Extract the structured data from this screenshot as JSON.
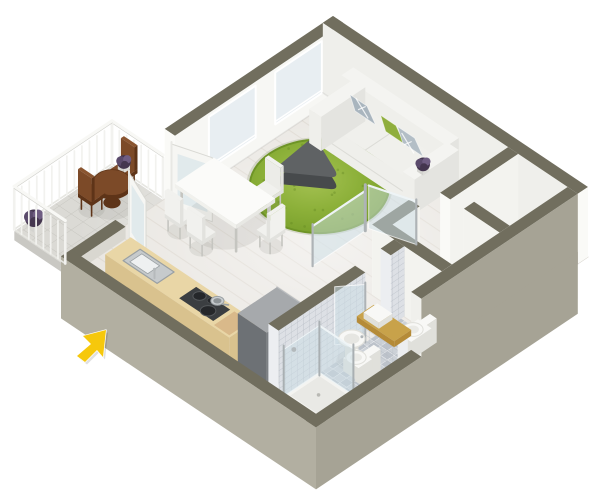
{
  "meta": {
    "description": "3D isometric dollhouse-style floor plan rendering of a studio apartment with living room, dining area, kitchen, bathroom and balcony, with a yellow cursor arrow at lower left",
    "width": 600,
    "height": 497
  },
  "colors": {
    "bg": "#ffffff",
    "floor": "#e9e6e1",
    "plank": "#ddd8d0",
    "wallTop": "#716e5e",
    "wallTopLight": "#7d7a69",
    "wallInnerNW": "#f7f7f4",
    "wallInnerNE": "#efefeb",
    "wallWhite": "#f3f3ef",
    "wallEnd": "#fafaf7",
    "skirtSE": "#a6a395",
    "skirtSW": "#b2afa1",
    "window": "#e8eef2",
    "windowFrame": "#ffffff",
    "glass": "rgba(204,222,230,0.5)",
    "glassEdge": "#eef4f6",
    "metal": "#aeb3b6",
    "rugEdge": "#6e9426",
    "rugDot": "#5f8520",
    "coffeeTop": "#5f6264",
    "coffeeSide": "#474a4c",
    "sofaTop": "#f4f4f1",
    "sofaFront": "#efefeb",
    "sofaSide": "#e4e4e0",
    "sofaSeat": "#f0f0ec",
    "seam": "#dcdcd7",
    "pillowGray": "#a9b5be",
    "pillowGray2": "#b3bec6",
    "pillowGreen": "#8fae3c",
    "tableTop": "#fbfbf9",
    "tableSide": "#e8e8e4",
    "leg": "#c5c5c0",
    "chairSeat": "#f1f1ee",
    "chairShade": "#e2e2de",
    "wood": "#7c4a28",
    "woodDark": "#5e3418",
    "woodTop": "#8a5530",
    "plantDark": "#44364f",
    "plantMid": "#5a4a6b",
    "plantHi": "#6f5d82",
    "pot": "#ececea",
    "counter": "#e9d6a6",
    "counterSide": "#d9c28e",
    "sinkSteel": "#c6cacc",
    "sinkDark": "#9aa0a3",
    "cooktop": "#3b3e41",
    "burner": "#25272a",
    "steel": "#c9cdd0",
    "board": "#d9b98a",
    "fridgeTop": "#a6a9ac",
    "fridgeX": "#7c8084",
    "fridgeY": "#6d7175",
    "tileBase": "#dde0e5",
    "tileLine": "#b4bac2",
    "bathFloor": "#ccd1d7",
    "gold": "#c8a24a",
    "goldSide": "#b58b38",
    "fixture": "#f8f8f6",
    "fixtureShade": "#e0e0db",
    "railing": "#f2f2ef",
    "railTop": "#f8f8f5",
    "railShadow": "#cfcfca",
    "balcTile": "#dbdad5",
    "balcEdge": "#c9c8c3",
    "shadow": "rgba(90,90,80,0.10)",
    "cursor": "#f6c80c"
  },
  "projection": {
    "origin": [
      333,
      86
    ],
    "ux": 0.85,
    "uy": 0.57,
    "wall_height": 70,
    "stub_height": 12,
    "skirt": 62
  },
  "plan": {
    "x_size": 300,
    "y_size": 320,
    "wall": 12
  },
  "nw_wall": {
    "full_to": 198,
    "stub_from": 256,
    "windows": [
      [
        25,
        80
      ],
      [
        103,
        158
      ]
    ],
    "win_z": [
      14,
      66
    ],
    "door": [
      198,
      256
    ]
  },
  "balcony": {
    "x": [
      -60,
      0
    ],
    "y": [
      200,
      315
    ],
    "rail_h": 42,
    "table": {
      "c": [
        -26,
        234
      ],
      "r": 16,
      "h": 22
    },
    "chair_a": {
      "x": [
        -44,
        -28
      ],
      "y": [
        202,
        218
      ],
      "back": "y0"
    },
    "chair_b": {
      "x": [
        -42,
        -26
      ],
      "y": [
        242,
        258
      ],
      "back": "y1"
    },
    "chair_plant": [
      -36,
      210
    ],
    "floor_plant": [
      -52,
      300
    ]
  },
  "balcony_door_leaves": [
    {
      "a": [
        12,
        202
      ],
      "b": [
        48,
        190
      ]
    },
    {
      "a": [
        12,
        252
      ],
      "b": [
        46,
        266
      ]
    }
  ],
  "living": {
    "sofa": {
      "arms": [
        [
          36,
          50
        ],
        [
          146,
          160
        ]
      ],
      "y": [
        12,
        64
      ],
      "back_y": [
        12,
        26
      ],
      "seat": [
        50,
        146
      ]
    },
    "rug": {
      "c": [
        80,
        96
      ],
      "r": 58
    },
    "coffee_table": {
      "pts": [
        [
          52,
          74
        ],
        [
          104,
          96
        ],
        [
          58,
          130
        ]
      ],
      "h": 22
    },
    "plant": [
      128,
      22
    ]
  },
  "dining": {
    "table": {
      "x": [
        20,
        92
      ],
      "y": [
        160,
        206
      ],
      "h": 31
    },
    "chairs": [
      {
        "x": [
          58,
          76
        ],
        "y": [
          134,
          150
        ],
        "back": "y0"
      },
      {
        "x": [
          28,
          46
        ],
        "y": [
          210,
          226
        ],
        "back": "y1"
      },
      {
        "x": [
          56,
          74
        ],
        "y": [
          212,
          228
        ],
        "back": "y1"
      },
      {
        "x": [
          96,
          112
        ],
        "y": [
          168,
          186
        ],
        "back": "x1"
      }
    ]
  },
  "hall": {
    "w1": {
      "x": [
        218,
        230
      ],
      "y": [
        12,
        92
      ]
    },
    "p1": {
      "x": [
        246,
        288
      ],
      "y": [
        80,
        92
      ]
    },
    "p2": {
      "x": [
        206,
        288
      ],
      "y": [
        148,
        160
      ],
      "ret_x": [
        206,
        218
      ],
      "ret_y": [
        116,
        160
      ]
    }
  },
  "se_tall": {
    "y": [
      12,
      196
    ]
  },
  "glass_partition": {
    "wall": {
      "x": 146,
      "y": [
        108,
        170
      ],
      "h": 40
    },
    "door": {
      "a": [
        146,
        104
      ],
      "b": [
        188,
        90
      ],
      "h": 43
    }
  },
  "kitchen": {
    "counter": {
      "x": [
        40,
        186
      ],
      "y": [
        278,
        308
      ],
      "h": 30
    },
    "sink": {
      "x": [
        56,
        96
      ],
      "y": [
        283,
        303
      ]
    },
    "faucet": [
      90,
      300
    ],
    "cooktop": {
      "x": [
        122,
        162
      ],
      "y": [
        283,
        303
      ]
    },
    "pot": [
      152,
      288
    ],
    "board": {
      "x": [
        166,
        184
      ],
      "y": [
        282,
        306
      ]
    }
  },
  "fridge": {
    "x": [
      196,
      230
    ],
    "y": [
      262,
      308
    ],
    "h": 60
  },
  "bathroom": {
    "b1": {
      "x": [
        232,
        244
      ],
      "y": [
        160,
        308
      ],
      "door": [
        176,
        206
      ]
    },
    "floor": {
      "x": [
        244,
        288
      ],
      "y": [
        164,
        308
      ]
    },
    "hall_toilet": {
      "base": [
        266,
        166,
        282,
        190
      ],
      "tank": [
        278,
        164,
        286,
        192
      ],
      "bowl": [
        272,
        178
      ]
    },
    "vanity": {
      "x": [
        244,
        288
      ],
      "y": [
        200,
        212
      ],
      "h": 26,
      "basin": [
        250,
        268
      ]
    },
    "sink": {
      "c": [
        252,
        230
      ],
      "r": 11
    },
    "toilet2": {
      "base": [
        256,
        228,
        274,
        244
      ],
      "tank": [
        272,
        224,
        280,
        246
      ],
      "bowl": [
        263,
        236
      ]
    },
    "shower": {
      "x": [
        246,
        286
      ],
      "y": [
        262,
        304
      ],
      "glass_h": 50
    },
    "door_leaf": {
      "a": [
        244,
        206
      ],
      "b": [
        228,
        226
      ],
      "h": 58
    }
  },
  "cursor": {
    "points": [
      [
        106,
        330
      ],
      [
        83,
        336
      ],
      [
        91,
        344
      ],
      [
        77,
        356
      ],
      [
        85,
        362
      ],
      [
        97,
        350
      ],
      [
        103,
        357
      ]
    ]
  }
}
